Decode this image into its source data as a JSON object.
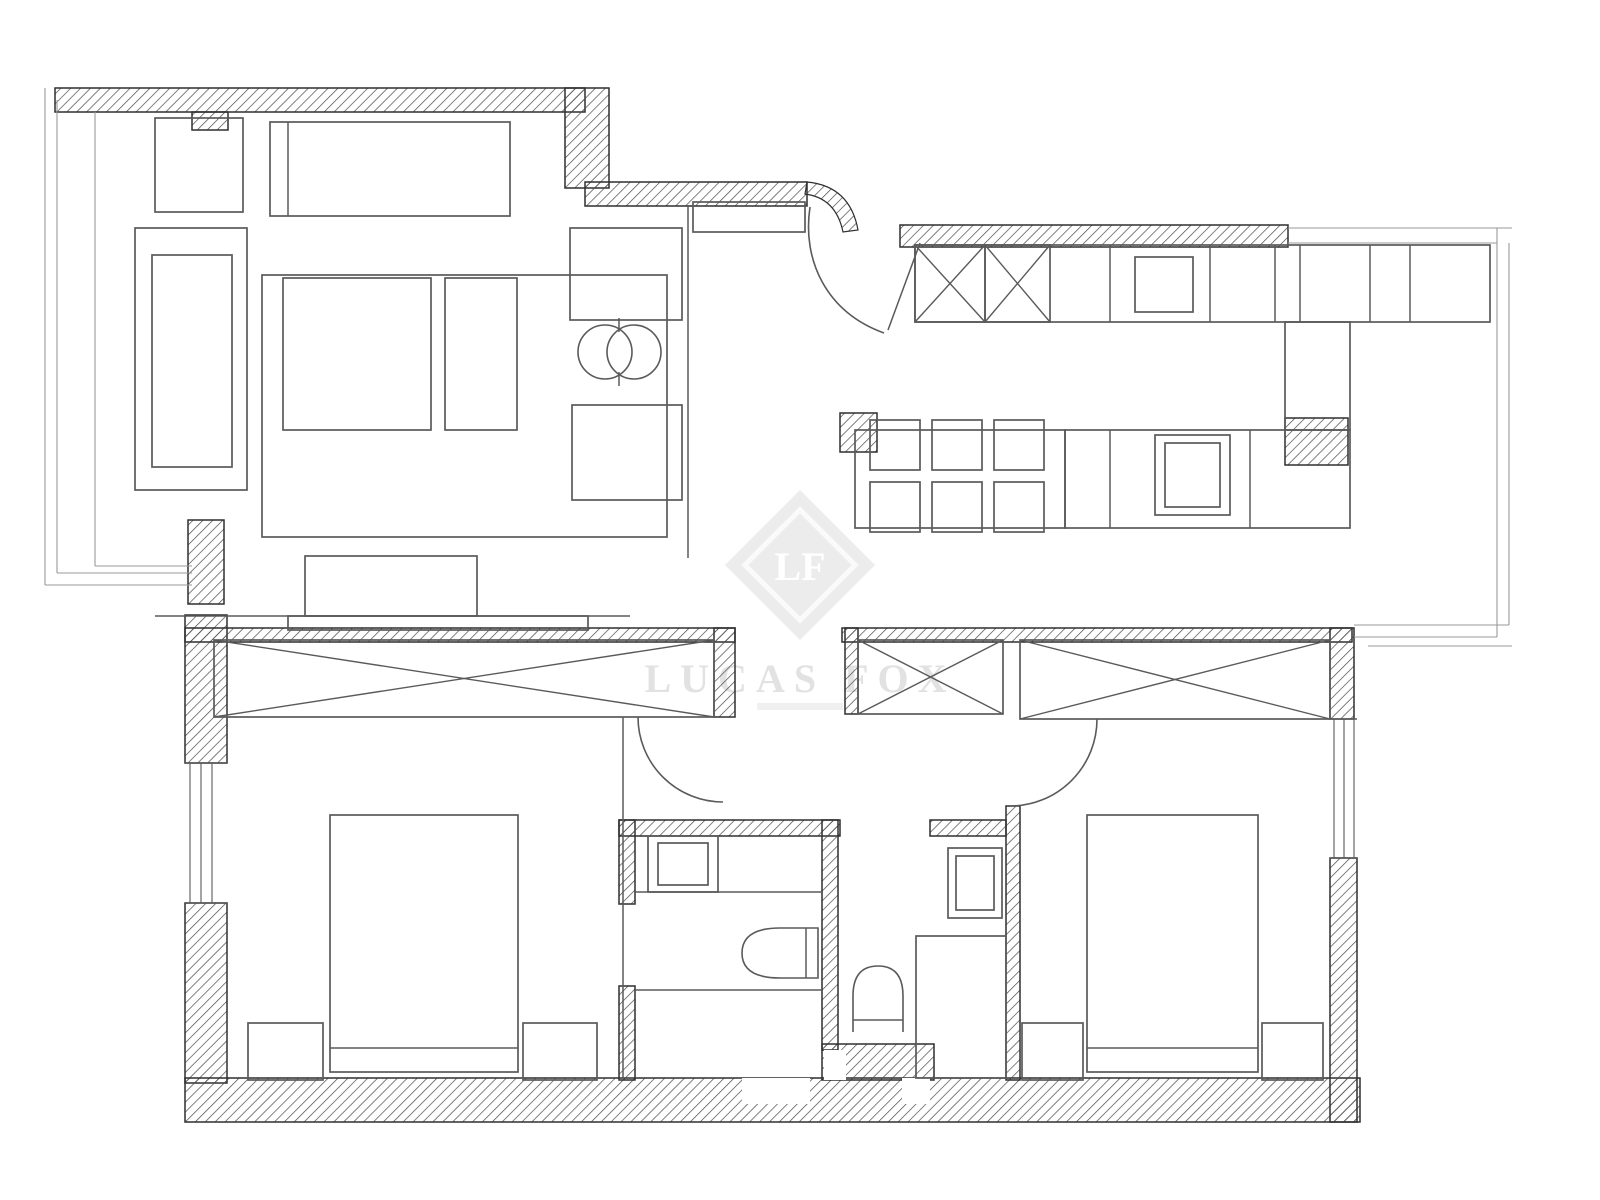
{
  "watermark": {
    "monogram": "LF",
    "brand": "LUCAS FOX"
  },
  "canvas": {
    "width": 1600,
    "height": 1200,
    "background": "#ffffff",
    "wall_line": "#2f2f2f",
    "furniture_line": "#5a5a5a",
    "thin_line": "#999999",
    "hatch_line": "#4a4a4a",
    "watermark_fill": "#ececec",
    "watermark_text": "#e2e2e2"
  },
  "plan": {
    "hatched_walls": [
      {
        "n": "living-top-wall",
        "r": [
          55,
          88,
          530,
          24
        ]
      },
      {
        "n": "living-wall-step",
        "r": [
          565,
          88,
          44,
          100
        ]
      },
      {
        "n": "entry-top-wall",
        "r": [
          585,
          182,
          222,
          24
        ]
      },
      {
        "n": "living-wall-stub",
        "r": [
          192,
          112,
          36,
          18
        ]
      },
      {
        "n": "kitchen-top-wall",
        "r": [
          900,
          225,
          388,
          22
        ]
      },
      {
        "n": "kitchen-pillar",
        "r": [
          1285,
          418,
          63,
          47
        ]
      },
      {
        "n": "dining-corner-pillar",
        "r": [
          840,
          413,
          37,
          39
        ]
      },
      {
        "n": "bedroom1-left-wall-upper",
        "r": [
          185,
          615,
          42,
          148
        ]
      },
      {
        "n": "bedroom1-left-wall-lower",
        "r": [
          185,
          903,
          42,
          180
        ]
      },
      {
        "n": "bedroom1-top-wall",
        "r": [
          185,
          628,
          550,
          14
        ]
      },
      {
        "n": "bedroom1-wardrobe-cap",
        "r": [
          714,
          628,
          21,
          89
        ]
      },
      {
        "n": "living-bedroom-junction-pillar",
        "r": [
          188,
          520,
          36,
          84
        ]
      },
      {
        "n": "bottom-exterior-wall",
        "r": [
          185,
          1078,
          1175,
          44
        ]
      },
      {
        "n": "bathroom1-left-wall-upper",
        "r": [
          619,
          820,
          16,
          84
        ]
      },
      {
        "n": "bathroom1-left-wall-lower",
        "r": [
          619,
          986,
          16,
          94
        ]
      },
      {
        "n": "bathroom1-top-wall",
        "r": [
          619,
          820,
          221,
          16
        ]
      },
      {
        "n": "bathroom1-right-wall",
        "r": [
          822,
          820,
          16,
          230
        ]
      },
      {
        "n": "bathrooms-bottom-wall",
        "r": [
          822,
          1044,
          112,
          36
        ]
      },
      {
        "n": "bathroom2-top-wall",
        "r": [
          930,
          820,
          76,
          16
        ]
      },
      {
        "n": "bathroom2-right-wall",
        "r": [
          1006,
          806,
          14,
          274
        ]
      },
      {
        "n": "hall-closet-cap",
        "r": [
          845,
          628,
          13,
          86
        ]
      },
      {
        "n": "bedroom2-top-wall",
        "r": [
          842,
          628,
          510,
          14
        ]
      },
      {
        "n": "bedroom2-wardrobe-cap",
        "r": [
          1330,
          628,
          24,
          91
        ]
      },
      {
        "n": "bedroom2-right-wall-lower",
        "r": [
          1330,
          858,
          27,
          264
        ]
      }
    ],
    "wall_notches": [
      {
        "n": "bottom-wall-recess-1",
        "r": [
          742,
          1078,
          68,
          26
        ]
      },
      {
        "n": "bathroom-wall-recess",
        "r": [
          824,
          1050,
          22,
          30
        ]
      },
      {
        "n": "bottom-wall-recess-2",
        "r": [
          902,
          1078,
          28,
          26
        ]
      }
    ],
    "xboxes": [
      {
        "n": "kitchen-cabinet-x1",
        "r": [
          915,
          245,
          70,
          77
        ]
      },
      {
        "n": "kitchen-cabinet-x2",
        "r": [
          985,
          245,
          65,
          77
        ]
      },
      {
        "n": "bedroom1-wardrobe",
        "r": [
          214,
          640,
          500,
          77
        ]
      },
      {
        "n": "hall-closet",
        "r": [
          858,
          640,
          145,
          74
        ]
      },
      {
        "n": "bedroom2-wardrobe",
        "r": [
          1020,
          640,
          310,
          79
        ]
      }
    ],
    "furniture": [
      {
        "n": "living-cabinet",
        "r": [
          155,
          118,
          88,
          94
        ]
      },
      {
        "n": "living-sideboard",
        "r": [
          270,
          122,
          240,
          94
        ]
      },
      {
        "n": "entry-shelf",
        "r": [
          693,
          202,
          112,
          30
        ]
      },
      {
        "n": "sofa",
        "r": [
          135,
          228,
          112,
          262
        ]
      },
      {
        "n": "sofa-cushion",
        "r": [
          152,
          255,
          80,
          212
        ]
      },
      {
        "n": "living-rug",
        "r": [
          262,
          275,
          405,
          262
        ]
      },
      {
        "n": "coffee-table",
        "r": [
          283,
          278,
          148,
          152
        ]
      },
      {
        "n": "side-table",
        "r": [
          445,
          278,
          72,
          152
        ]
      },
      {
        "n": "armchair-1",
        "r": [
          570,
          228,
          112,
          92
        ]
      },
      {
        "n": "armchair-2",
        "r": [
          572,
          405,
          110,
          95
        ]
      },
      {
        "n": "tv-unit",
        "r": [
          305,
          556,
          172,
          60
        ]
      },
      {
        "n": "tv-base",
        "r": [
          288,
          616,
          300,
          14
        ]
      },
      {
        "n": "kitchen-top-counter",
        "r": [
          915,
          245,
          575,
          77
        ]
      },
      {
        "n": "kitchen-column",
        "r": [
          1285,
          322,
          65,
          108
        ]
      },
      {
        "n": "kitchen-lower-counter",
        "r": [
          1065,
          430,
          285,
          98
        ]
      },
      {
        "n": "dining-table",
        "r": [
          855,
          430,
          210,
          98
        ]
      },
      {
        "n": "dining-chair-1",
        "r": [
          870,
          420,
          50,
          50
        ]
      },
      {
        "n": "dining-chair-2",
        "r": [
          932,
          420,
          50,
          50
        ]
      },
      {
        "n": "dining-chair-3",
        "r": [
          994,
          420,
          50,
          50
        ]
      },
      {
        "n": "dining-chair-4",
        "r": [
          870,
          482,
          50,
          50
        ]
      },
      {
        "n": "dining-chair-5",
        "r": [
          932,
          482,
          50,
          50
        ]
      },
      {
        "n": "dining-chair-6",
        "r": [
          994,
          482,
          50,
          50
        ]
      },
      {
        "n": "kitchen-appliance-top",
        "r": [
          1135,
          257,
          58,
          55
        ]
      },
      {
        "n": "kitchen-appliance-lower",
        "r": [
          1155,
          435,
          75,
          80
        ]
      },
      {
        "n": "kitchen-appliance-lower-inner",
        "r": [
          1165,
          443,
          55,
          64
        ]
      },
      {
        "n": "bathroom1-sink",
        "r": [
          648,
          836,
          70,
          56
        ]
      },
      {
        "n": "bathroom1-sink-basin",
        "r": [
          658,
          843,
          50,
          42
        ]
      },
      {
        "n": "bathroom2-sink",
        "r": [
          948,
          848,
          54,
          70
        ]
      },
      {
        "n": "bathroom2-sink-basin",
        "r": [
          956,
          856,
          38,
          54
        ]
      },
      {
        "n": "bathroom2-shower",
        "r": [
          916,
          936,
          90,
          142
        ]
      },
      {
        "n": "bed-1",
        "r": [
          330,
          815,
          188,
          257
        ]
      },
      {
        "n": "nightstand-1",
        "r": [
          248,
          1023,
          75,
          57
        ]
      },
      {
        "n": "nightstand-2",
        "r": [
          523,
          1023,
          74,
          57
        ]
      },
      {
        "n": "bed-2",
        "r": [
          1087,
          815,
          171,
          257
        ]
      },
      {
        "n": "nightstand-3",
        "r": [
          1022,
          1023,
          61,
          57
        ]
      },
      {
        "n": "nightstand-4",
        "r": [
          1262,
          1023,
          61,
          57
        ]
      }
    ],
    "lines": [
      {
        "n": "sideboard-divider",
        "p": [
          288,
          122,
          288,
          216
        ]
      },
      {
        "n": "balcony-outer-v",
        "p": [
          45,
          88,
          45,
          585
        ],
        "t": 1
      },
      {
        "n": "balcony-inner-v",
        "p": [
          57,
          100,
          57,
          573
        ],
        "t": 1
      },
      {
        "n": "balcony-outer-h",
        "p": [
          45,
          585,
          192,
          585
        ],
        "t": 1
      },
      {
        "n": "balcony-inner-h",
        "p": [
          57,
          573,
          192,
          573
        ],
        "t": 1
      },
      {
        "n": "living-floor-left",
        "p": [
          95,
          112,
          95,
          566
        ],
        "t": 1
      },
      {
        "n": "living-floor-bottom-left",
        "p": [
          95,
          566,
          192,
          566
        ],
        "t": 1
      },
      {
        "n": "living-divider",
        "p": [
          688,
          205,
          688,
          558
        ]
      },
      {
        "n": "living-floor-bottom",
        "p": [
          155,
          616,
          630,
          616
        ]
      },
      {
        "n": "kitchen-top-edge-1",
        "p": [
          1288,
          228,
          1512,
          228
        ],
        "t": 1
      },
      {
        "n": "kitchen-top-edge-2",
        "p": [
          1288,
          243,
          1497,
          243
        ],
        "t": 1
      },
      {
        "n": "terrace-right-outer",
        "p": [
          1497,
          228,
          1497,
          637
        ],
        "t": 1
      },
      {
        "n": "terrace-right-inner",
        "p": [
          1509,
          243,
          1509,
          625
        ],
        "t": 1
      },
      {
        "n": "terrace-bottom-inner",
        "p": [
          1354,
          625,
          1509,
          625
        ],
        "t": 1
      },
      {
        "n": "terrace-bottom-outer",
        "p": [
          1354,
          637,
          1497,
          637
        ],
        "t": 1
      },
      {
        "n": "terrace-bottom-stub",
        "p": [
          1368,
          646,
          1512,
          646
        ],
        "t": 1
      },
      {
        "n": "kitchen-counter-div-1",
        "p": [
          1110,
          245,
          1110,
          322
        ]
      },
      {
        "n": "kitchen-counter-div-2",
        "p": [
          1210,
          245,
          1210,
          322
        ]
      },
      {
        "n": "kitchen-counter-div-3",
        "p": [
          1275,
          245,
          1275,
          322
        ]
      },
      {
        "n": "kitchen-counter-div-4",
        "p": [
          1300,
          245,
          1300,
          322
        ]
      },
      {
        "n": "kitchen-counter-div-5",
        "p": [
          1370,
          245,
          1370,
          322
        ]
      },
      {
        "n": "kitchen-counter-div-6",
        "p": [
          1410,
          245,
          1410,
          322
        ]
      },
      {
        "n": "kitchen-lower-div-1",
        "p": [
          1110,
          430,
          1110,
          528
        ]
      },
      {
        "n": "kitchen-lower-div-2",
        "p": [
          1250,
          430,
          1250,
          528
        ]
      },
      {
        "n": "bedroom1-right-wall-line",
        "p": [
          623,
          717,
          623,
          1078
        ]
      },
      {
        "n": "bathroom1-counter-edge",
        "p": [
          635,
          892,
          822,
          892
        ]
      },
      {
        "n": "bathroom1-zone-divider",
        "p": [
          635,
          990,
          822,
          990
        ]
      },
      {
        "n": "bed1-foot-line",
        "p": [
          330,
          1048,
          518,
          1048
        ]
      },
      {
        "n": "bed2-foot-line",
        "p": [
          1087,
          1048,
          1258,
          1048
        ]
      },
      {
        "n": "toilet1-seat-line",
        "p": [
          806,
          928,
          806,
          978
        ]
      },
      {
        "n": "toilet2-tank-line",
        "p": [
          853,
          1020,
          903,
          1020
        ]
      },
      {
        "n": "entry-door-leaf",
        "p": [
          888,
          330,
          920,
          243
        ]
      },
      {
        "n": "decor-tick-top",
        "p": [
          619,
          318,
          619,
          332
        ]
      },
      {
        "n": "decor-tick-bottom",
        "p": [
          619,
          372,
          619,
          386
        ]
      },
      {
        "n": "window1-cap-top",
        "p": [
          185,
          763,
          227,
          763
        ]
      },
      {
        "n": "window1-cap-bottom",
        "p": [
          185,
          903,
          227,
          903
        ]
      },
      {
        "n": "window2-cap-top",
        "p": [
          1330,
          719,
          1357,
          719
        ]
      },
      {
        "n": "window2-cap-bottom",
        "p": [
          1330,
          858,
          1357,
          858
        ]
      }
    ],
    "windows": [
      {
        "n": "bedroom1-window",
        "at": [
          190,
          201,
          212
        ],
        "from": 763,
        "to": 903
      },
      {
        "n": "bedroom2-window",
        "at": [
          1334,
          1344,
          1354
        ],
        "from": 719,
        "to": 858
      }
    ],
    "circles": [
      {
        "n": "decor-circle-1",
        "c": [
          605,
          352,
          27
        ]
      },
      {
        "n": "decor-circle-2",
        "c": [
          634,
          352,
          27
        ]
      }
    ],
    "paths": [
      {
        "n": "entry-door-arc",
        "d": "M 810 207 C 802 260 826 312 884 333",
        "cls": "fpath"
      },
      {
        "n": "entry-wall-hook",
        "d": "M 807 182 Q 850 186 858 230 L 843 232 Q 836 198 805 194 Z",
        "cls": "hook"
      },
      {
        "n": "bedroom1-door-arc",
        "d": "M 638 717 A 85 85 0 0 0 723 802",
        "cls": "fpath"
      },
      {
        "n": "bedroom2-door-arc",
        "d": "M 1097 719 A 87 87 0 0 1 1010 806",
        "cls": "fpath"
      },
      {
        "n": "toilet-1",
        "d": "M 818 928 L 780 928 Q 742 928 742 953 Q 742 978 780 978 L 818 978 Z",
        "cls": "fpath"
      },
      {
        "n": "toilet-2",
        "d": "M 853 1032 L 853 996 Q 853 966 878 966 Q 903 966 903 996 L 903 1032",
        "cls": "fpath"
      }
    ]
  }
}
